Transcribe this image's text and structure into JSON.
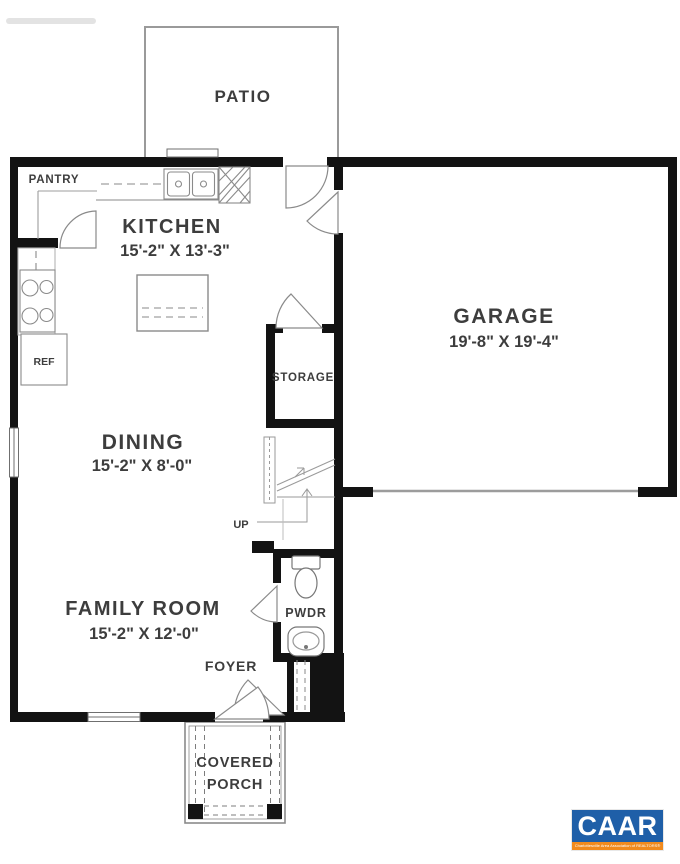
{
  "rooms": {
    "patio": {
      "label": "PATIO"
    },
    "pantry": {
      "label": "PANTRY"
    },
    "kitchen": {
      "label": "KITCHEN",
      "dims": "15'-2\" X 13'-3\""
    },
    "garage": {
      "label": "GARAGE",
      "dims": "19'-8\" X 19'-4\""
    },
    "storage": {
      "label": "STORAGE"
    },
    "dining": {
      "label": "DINING",
      "dims": "15'-2\" X 8'-0\""
    },
    "family_room": {
      "label": "FAMILY ROOM",
      "dims": "15'-2\" X 12'-0\""
    },
    "pwdr": {
      "label": "PWDR"
    },
    "foyer": {
      "label": "FOYER"
    },
    "covered_porch": {
      "line1": "COVERED",
      "line2": "PORCH"
    }
  },
  "fixtures": {
    "ref": "REF",
    "up": "UP"
  },
  "logo": {
    "name": "CAAR",
    "tagline": "Charlottesville Area Association of REALTORS®",
    "bg_color": "#1f5fa8",
    "accent_color": "#f18a1d"
  },
  "colors": {
    "wall": "#131313",
    "line": "#8d8d8d",
    "text": "#3d3d3d"
  }
}
